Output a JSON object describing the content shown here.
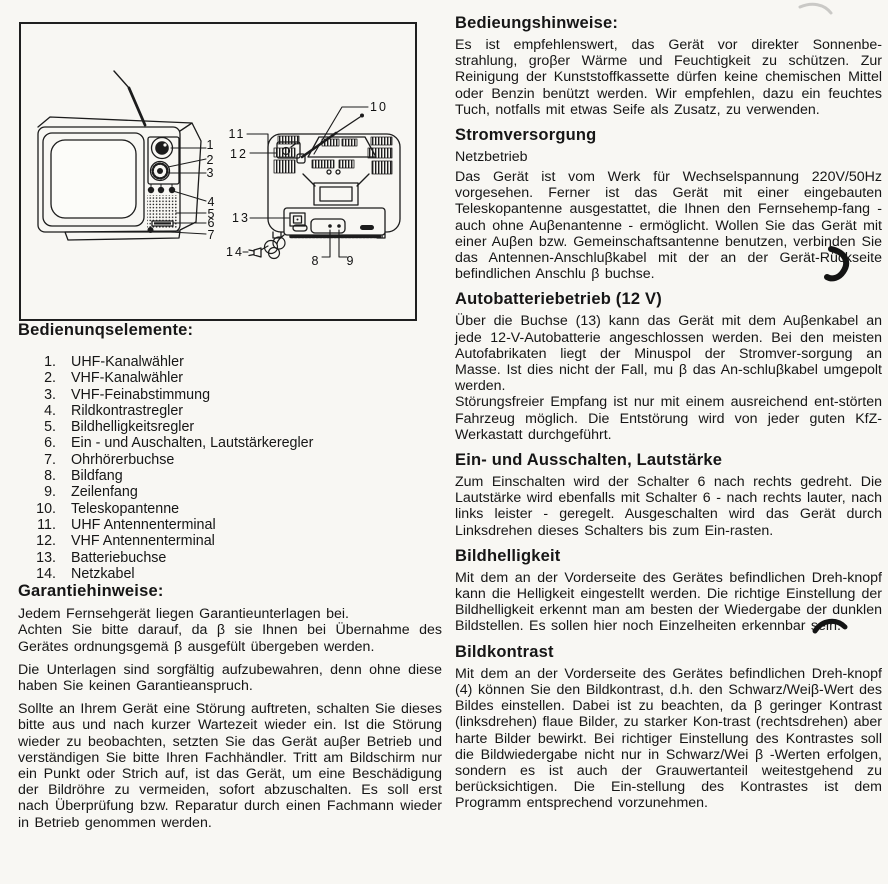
{
  "colors": {
    "paper": "#f8f7f3",
    "ink": "#161616"
  },
  "figure": {
    "callouts": [
      "1",
      "2",
      "3",
      "4",
      "5",
      "6",
      "7",
      "8",
      "9",
      "10",
      "11",
      "12",
      "13",
      "14"
    ]
  },
  "left": {
    "controls_heading": "Bedienunqselemente:",
    "controls": [
      {
        "num": "1.",
        "label": "UHF-Kanalwähler"
      },
      {
        "num": "2.",
        "label": "VHF-Kanalwähler"
      },
      {
        "num": "3.",
        "label": "VHF-Feinabstimmung"
      },
      {
        "num": "4.",
        "label": "Rildkontrastregler"
      },
      {
        "num": "5.",
        "label": "Bildhelligkeitsregler"
      },
      {
        "num": "6.",
        "label": "Ein - und Auschalten, Lautstärkeregler"
      },
      {
        "num": "7.",
        "label": "Ohrhörerbuchse"
      },
      {
        "num": "8.",
        "label": "Bildfang"
      },
      {
        "num": "9.",
        "label": "Zeilenfang"
      },
      {
        "num": "10.",
        "label": "Teleskopantenne"
      },
      {
        "num": "11.",
        "label": "UHF Antennenterminal"
      },
      {
        "num": "12.",
        "label": "VHF Antennenterminal"
      },
      {
        "num": "13.",
        "label": "Batteriebuchse"
      },
      {
        "num": "14.",
        "label": "Netzkabel"
      }
    ],
    "warranty_heading": "Garantiehinweise:",
    "warranty_paragraphs": [
      "Jedem Fernsehgerät liegen Garantieunterlagen bei.",
      "Achten Sie bitte darauf, da β sie Ihnen bei Übernahme des Gerätes ordnungsgemä β ausgefült übergeben werden.",
      "Die Unterlagen sind sorgfältig aufzubewahren, denn ohne diese haben Sie keinen Garantieanspruch.",
      "Sollte an Ihrem Gerät eine Störung auftreten, schalten Sie dieses bitte aus und nach kurzer Wartezeit wieder ein. Ist die Störung wieder zu beobachten, setzten Sie das Gerät auβer Betrieb und verständigen Sie bitte Ihren Fachhändler. Tritt am Bildschirm nur ein Punkt oder Strich auf, ist das Gerät, um eine Beschädigung der Bildröhre zu vermeiden, sofort abzuschalten. Es soll erst nach Überprüfung bzw. Reparatur durch einen Fachmann wieder in Betrieb genommen werden."
    ]
  },
  "right": {
    "sections": [
      {
        "heading": "Bedieungshinweise:",
        "paragraphs": [
          "Es ist empfehlenswert, das Gerät vor direkter Sonnenbe-strahlung, groβer Wärme und Feuchtigkeit zu schützen. Zur Reinigung der Kunststoffkassette dürfen keine chemischen Mittel oder Benzin benützt werden. Wir empfehlen, dazu ein feuchtes Tuch, notfalls mit etwas Seife als Zusatz, zu verwenden."
        ]
      },
      {
        "heading": "Stromversorgung",
        "subheading": "Netzbetrieb",
        "paragraphs": [
          "Das Gerät ist vom Werk für Wechselspannung 220V/50Hz vorgesehen. Ferner ist das Gerät mit einer eingebauten Teleskopantenne ausgestattet, die Ihnen den Fernsehemp-fang - auch ohne Auβenantenne - ermöglicht. Wollen Sie das Gerät mit einer Auβen bzw. Gemeinschaftsantenne benutzen, verbinden Sie das Antennen-Anschluβkabel mit der an der Gerät-Rückseite befindlichen Anschlu β buchse."
        ]
      },
      {
        "heading": "Autobatteriebetrieb (12 V)",
        "paragraphs": [
          "Über die Buchse (13) kann das Gerät mit dem Auβenkabel an jede 12-V-Autobatterie angeschlossen werden. Bei den meisten Autofabrikaten liegt der Minuspol der Stromver-sorgung an Masse. Ist dies nicht der Fall, mu β das An-schluβkabel umgepolt werden.",
          "Störungsfreier Empfang ist nur mit einem ausreichend ent-störten Fahrzeug möglich. Die Entstörung wird von jeder guten KfZ-Werkastatt durchgeführt."
        ]
      },
      {
        "heading": "Ein- und Ausschalten, Lautstärke",
        "paragraphs": [
          "Zum Einschalten wird der Schalter 6 nach rechts gedreht. Die Lautstärke wird ebenfalls mit Schalter 6 - nach rechts lauter, nach links leister - geregelt. Ausgeschalten wird das Gerät durch Linksdrehen dieses Schalters bis zum Ein-rasten."
        ]
      },
      {
        "heading": "Bildhelligkeit",
        "paragraphs": [
          "Mit dem an der Vorderseite des Gerätes befindlichen Dreh-knopf kann die Helligkeit eingestellt werden. Die richtige Einstellung der Bildhelligkeit erkennt man am besten der Wiedergabe der dunklen Bildstellen. Es sollen hier noch Einzelheiten erkennbar sein."
        ]
      },
      {
        "heading": "Bildkontrast",
        "paragraphs": [
          "Mit dem an der Vorderseite des Gerätes befindlichen Dreh-knopf (4) können Sie den Bildkontrast, d.h. den Schwarz/Weiβ-Wert des Bildes einstellen. Dabei ist zu beachten, da β geringer Kontrast (linksdrehen) flaue Bilder, zu starker Kon-trast (rechtsdrehen) aber harte Bilder bewirkt. Bei richtiger Einstellung des Kontrastes soll die Bildwiedergabe nicht nur in Schwarz/Wei β -Werten erfolgen, sondern es ist auch der Grauwertanteil weitestgehend zu berücksichtigen. Die Ein-stellung des Kontrastes ist dem Programm entsprechend vorzunehmen."
        ]
      }
    ]
  }
}
